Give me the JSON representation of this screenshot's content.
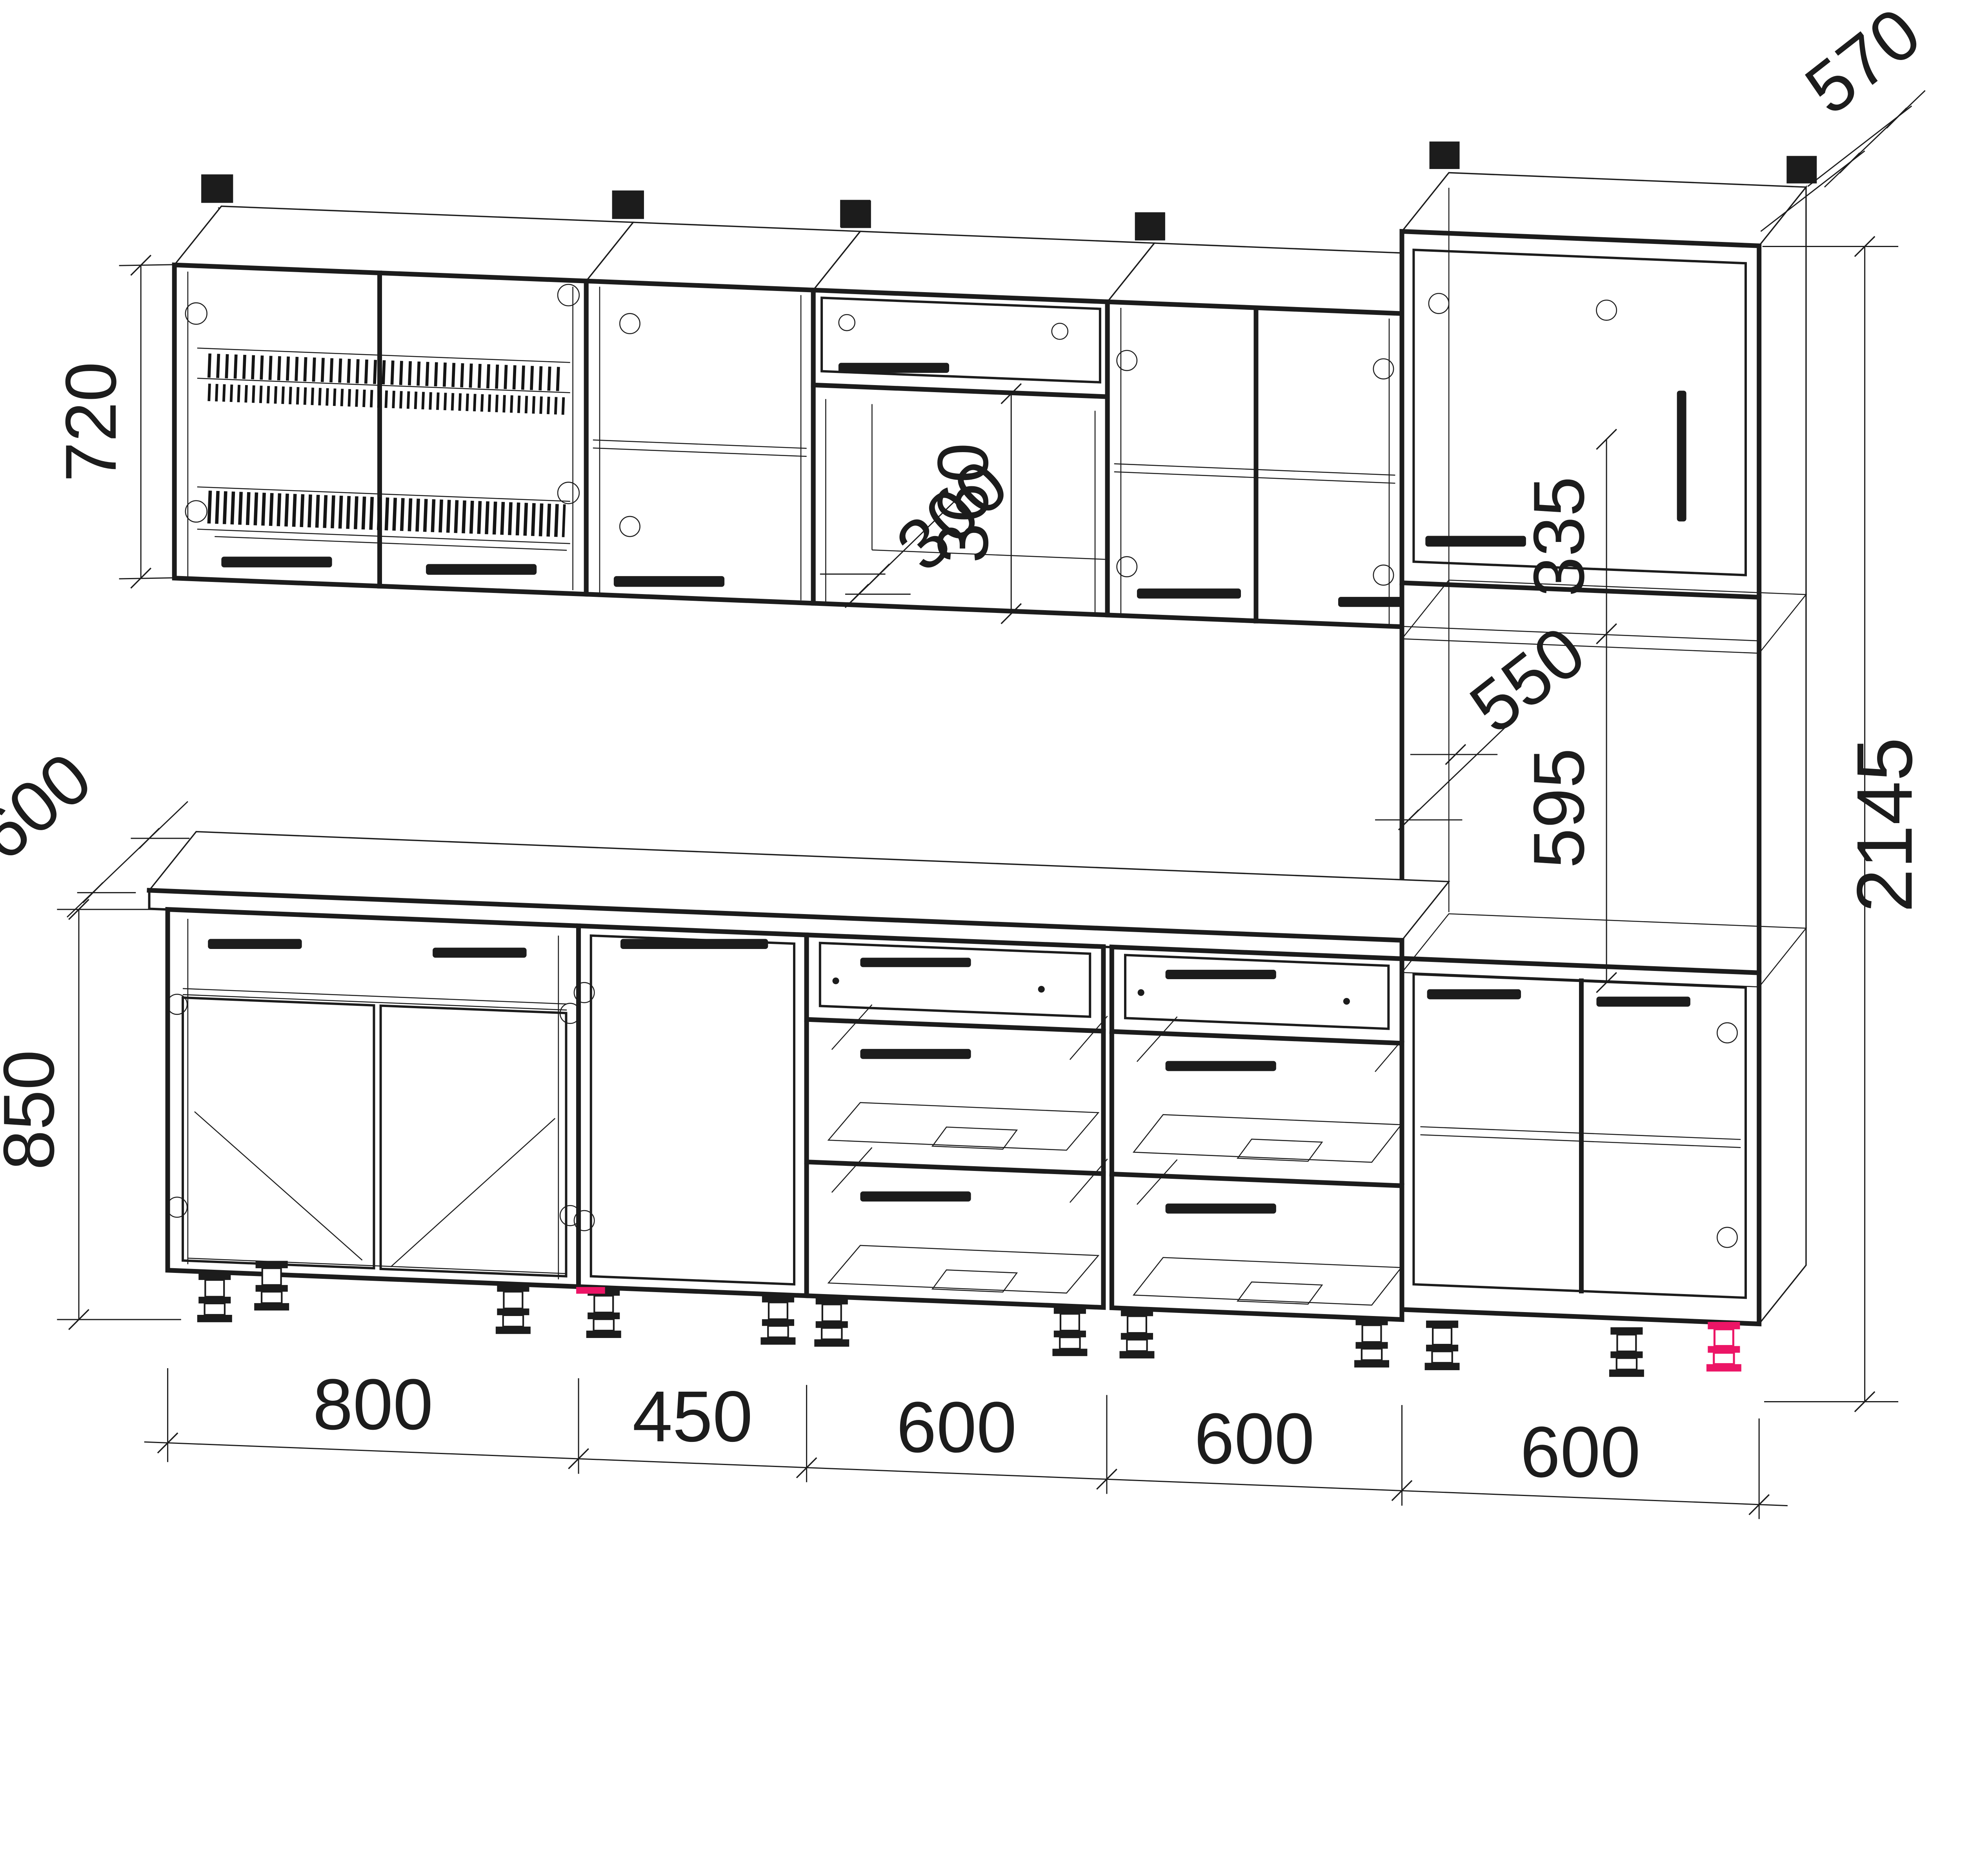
{
  "dimensions": {
    "wall_cabinet_height": "720",
    "wall_cabinet_depth": "300",
    "flip_door_opening_height": "360",
    "tall_cabinet_depth": "570",
    "tall_upper_niche_height": "335",
    "tall_inner_depth": "550",
    "tall_lower_niche_height": "595",
    "tall_cabinet_height": "2145",
    "countertop_depth": "600",
    "base_cabinet_height": "850",
    "base_widths": [
      "800",
      "450",
      "600",
      "600",
      "600"
    ]
  },
  "colors": {
    "line": "#1c1c1c",
    "highlight": "#ec1566"
  }
}
